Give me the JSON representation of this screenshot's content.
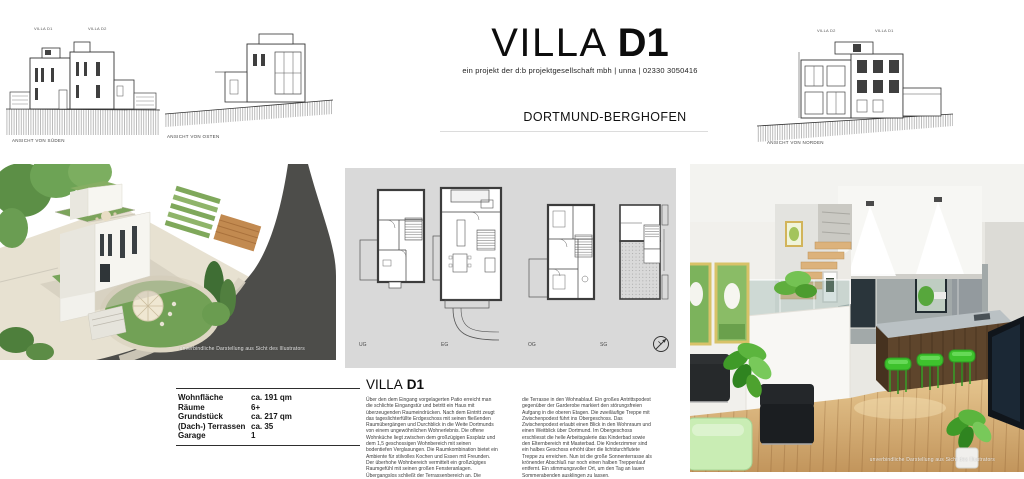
{
  "header": {
    "title_light": "VILLA",
    "title_bold": "D1",
    "subtitle": "ein projekt der d:b projektgesellschaft mbh | unna | 02330 3050416",
    "location": "DORTMUND-BERGHOFEN"
  },
  "elevations": {
    "south": {
      "caption": "ANSICHT VON SÜDEN",
      "label_left": "VILLA D1",
      "label_right": "VILLA D2"
    },
    "east": {
      "caption": "ANSICHT VON OSTEN"
    },
    "north": {
      "caption": "ANSICHT VON NORDEN",
      "label_left": "VILLA D2",
      "label_right": "VILLA D1"
    }
  },
  "plans": {
    "labels": [
      "UG",
      "EG",
      "OG",
      "SG"
    ],
    "compass": "north-arrow"
  },
  "specs": {
    "rows": [
      {
        "label": "Wohnfläche",
        "value": "ca. 191 qm"
      },
      {
        "label": "Räume",
        "value": "6+"
      },
      {
        "label": "Grundstück",
        "value": "ca. 217 qm"
      },
      {
        "label": "(Dach-) Terrassen",
        "value": "ca. 35"
      },
      {
        "label": "Garage",
        "value": "1"
      }
    ]
  },
  "description": {
    "heading_light": "VILLA",
    "heading_bold": "D1",
    "col1": "Über den dem Eingang vorgelagerten Patio erreicht man die schlichte Eingangstür und betritt ein Haus mit überzeugenden Raumeindrücken. Nach dem Eintritt zeugt das tageslichterfüllte Erdgeschoss mit seinen fließenden Raumübergängen und Durchblick in die Weite Dortmunds von einem ungewöhnlichen Wohnerlebnis. Die offene Wohnküche liegt zwischen dem großzügigen Essplatz und dem 1,5 geschossigen Wohnbereich mit seinen bodentiefen Verglasungen. Die Raumkombination bietet ein Ambiente für stilvolles Kochen und Essen mit Freunden. Der überhohe Wohnbereich vermittelt ein großzügiges Raumgefühl mit seinen großen Fensteranlagen. Übergangslos schließt der Terrassenbereich an. Die überhohen Fenster sorgen für ein lichtdurchflutetes Raumerlebnis und integriert",
    "col2": "die Terrasse in den Wohnablauf. Ein großes Antrittspodest gegenüber der Garderobe markiert den störungsfreien Aufgang in die oberen Etagen. Die zweiläufige Treppe mit Zwischenpodest führt ins Obergeschoss. Das Zwischenpodest erlaubt einen Blick in den Wohnraum und einen Weitblick über Dortmund. Im Obergeschoss erschliesst die helle Arbeitsgalerie das Kinderbad sowie den Elternbereich mit Masterbad. Die Kinderzimmer sind ein halbes Geschoss erhöht über die lichtdurchflutete Treppe zu erreichen. Nun ist die große Sonnenterrasse als krönender Abschluß nur noch einen halben Treppenlauf entfernt. Ein stimmungsvoller Ort, um den Tag an lauen Sommerabenden ausklingen zu lassen."
  },
  "renderings": {
    "exterior_caption": "unverbindliche Darstellung aus Sicht des Illustrators",
    "interior_caption": "unverbindliche Darstellung aus Sicht des Illustrators"
  },
  "colors": {
    "panel_gray": "#d9d9d9",
    "accent_green": "#3ec22d",
    "lawn_green": "#72a156",
    "road_gray": "#4d4d4a",
    "wood": "#d9ae74"
  }
}
